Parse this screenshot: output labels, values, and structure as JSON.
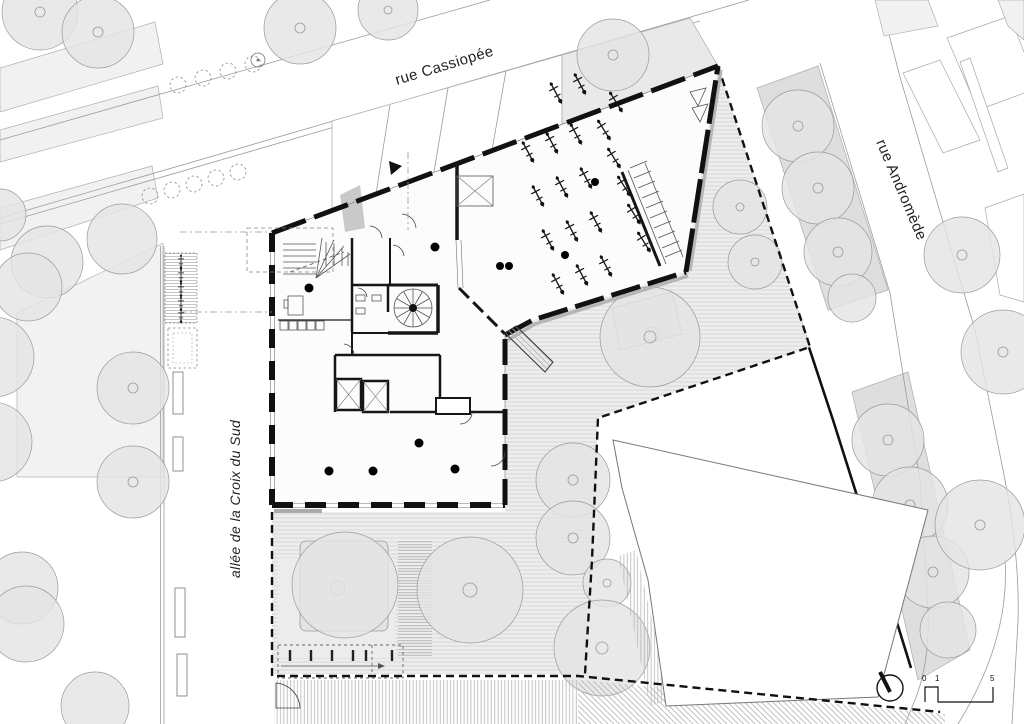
{
  "plan": {
    "title": "ground floor site plan",
    "streets": {
      "cassiopee": "rue Cassiopée",
      "andromede": "rue Andromède",
      "croix_du_sud": "allée de la Croix du Sud"
    },
    "scale_bar": {
      "t0": "0",
      "t1": "1",
      "t2": "5"
    },
    "icons": {
      "north_arrow": "compass-needle-circle",
      "entrance_marker": "solid-triangle"
    },
    "colors": {
      "wall": "#111111",
      "boundary": "#111111",
      "ground_hatch": "#d6d6d6",
      "garden": "#ededed",
      "tree_fill": "#e4e4e4",
      "planted_strip": "#dedede",
      "context_building": "#f1f1f1",
      "paper": "#ffffff"
    }
  }
}
